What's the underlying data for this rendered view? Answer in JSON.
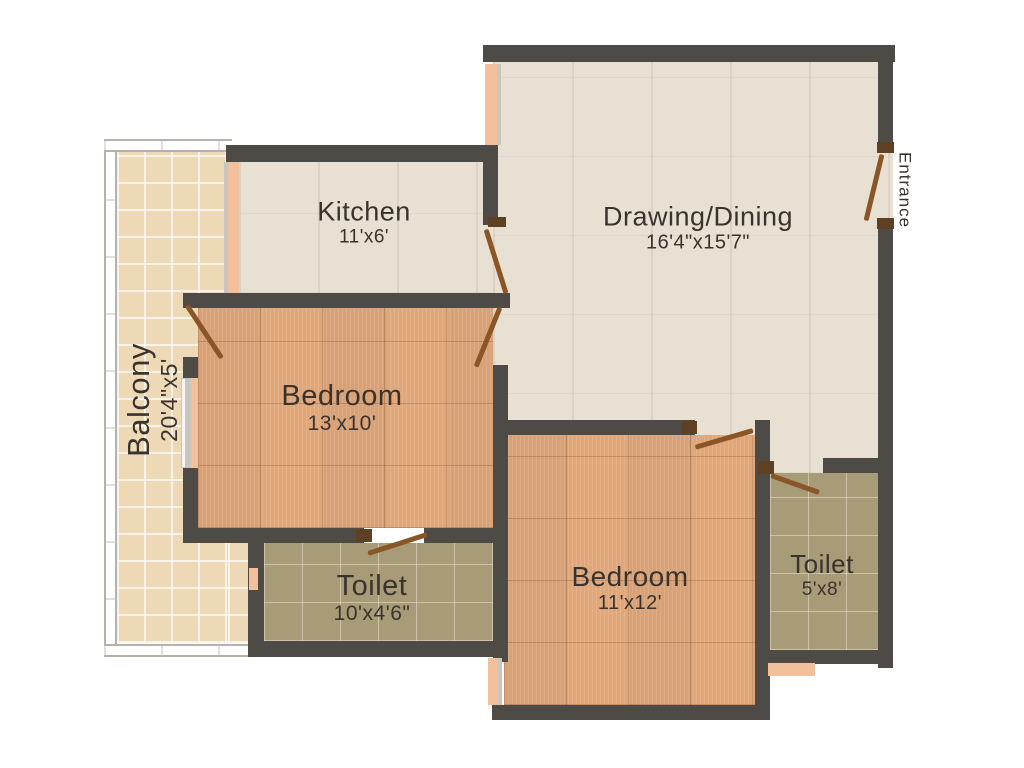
{
  "plan": {
    "type": "residential floor plan",
    "rooms": [
      {
        "id": "kitchen",
        "name": "Kitchen",
        "dimensions": "11'x6'",
        "floor": "ceramic-cream"
      },
      {
        "id": "drawing-dining",
        "name": "Drawing/Dining",
        "dimensions": "16'4\"x15'7\"",
        "floor": "ceramic-cream"
      },
      {
        "id": "bedroom-1",
        "name": "Bedroom",
        "dimensions": "13'x10'",
        "floor": "wood-tile"
      },
      {
        "id": "toilet-1",
        "name": "Toilet",
        "dimensions": "10'x4'6\"",
        "floor": "olive-tile"
      },
      {
        "id": "bedroom-2",
        "name": "Bedroom",
        "dimensions": "11'x12'",
        "floor": "wood-tile"
      },
      {
        "id": "toilet-2",
        "name": "Toilet",
        "dimensions": "5'x8'",
        "floor": "olive-tile"
      },
      {
        "id": "balcony",
        "name": "Balcony",
        "dimensions": "20'4\"x5'",
        "floor": "beige-tile"
      }
    ],
    "annotations": {
      "entrance": "Entrance"
    },
    "colors": {
      "wall": "#4e4a46",
      "floor_cream": "#e8e0d2",
      "floor_wood": "#e0a77a",
      "floor_olive": "#a89c78",
      "floor_balcony": "#eed9b6",
      "door_leaf": "#8a5527",
      "door_jamb": "#5e4023",
      "window_opening": "#f2c19b",
      "railing": "#b5b1ab",
      "text": "#3a332d",
      "background": "#ffffff"
    }
  }
}
